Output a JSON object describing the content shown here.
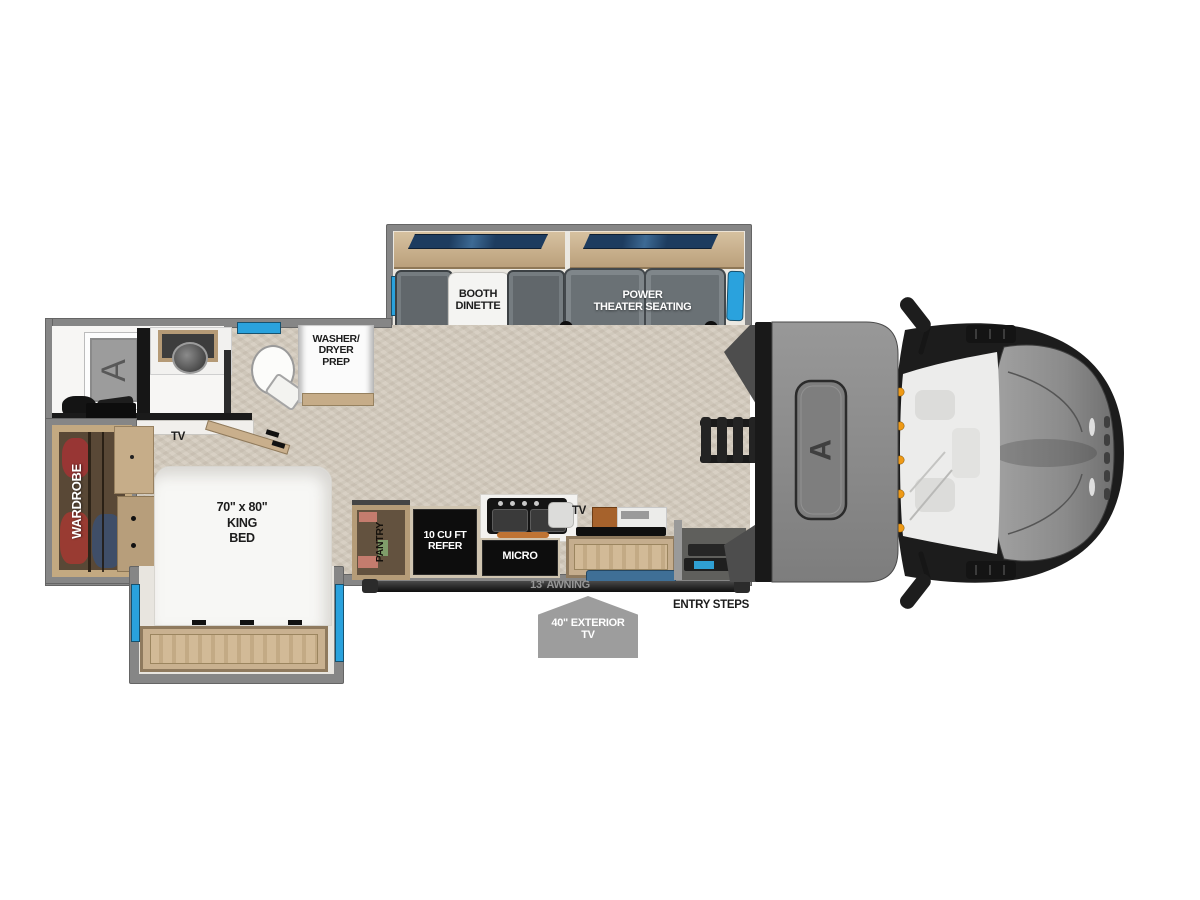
{
  "title": "31ZW",
  "colors": {
    "wall_gray": "#868686",
    "floor_beige": "#d4ccbf",
    "accent_blue": "#2aa2dd",
    "window_navy": "#1d3c5f",
    "wood": "#c7ae8c",
    "wood_dark": "#8f7a5e",
    "appliance_black": "#0d0d0d",
    "seat_gray": "#6c7377",
    "marker_orange": "#ef9a16",
    "badge_gray": "#9d9d9d"
  },
  "labels": {
    "booth_1": "BOOTH",
    "booth_2": "DINETTE",
    "theater_1": "POWER",
    "theater_2": "THEATER SEATING",
    "washer_1": "WASHER/",
    "washer_2": "DRYER",
    "washer_3": "PREP",
    "bedroom_tv": "TV",
    "wardrobe": "WARDROBE",
    "bed_1": "70\" x 80\"",
    "bed_2": "KING",
    "bed_3": "BED",
    "pantry": "PANTRY",
    "refer_1": "10 CU FT",
    "refer_2": "REFER",
    "micro": "MICRO",
    "kitchen_tv": "TV",
    "awning": "13' AWNING",
    "entry_steps": "ENTRY STEPS",
    "exterior_tv_1": "40\" EXTERIOR",
    "exterior_tv_2": "TV",
    "brand": "A"
  }
}
